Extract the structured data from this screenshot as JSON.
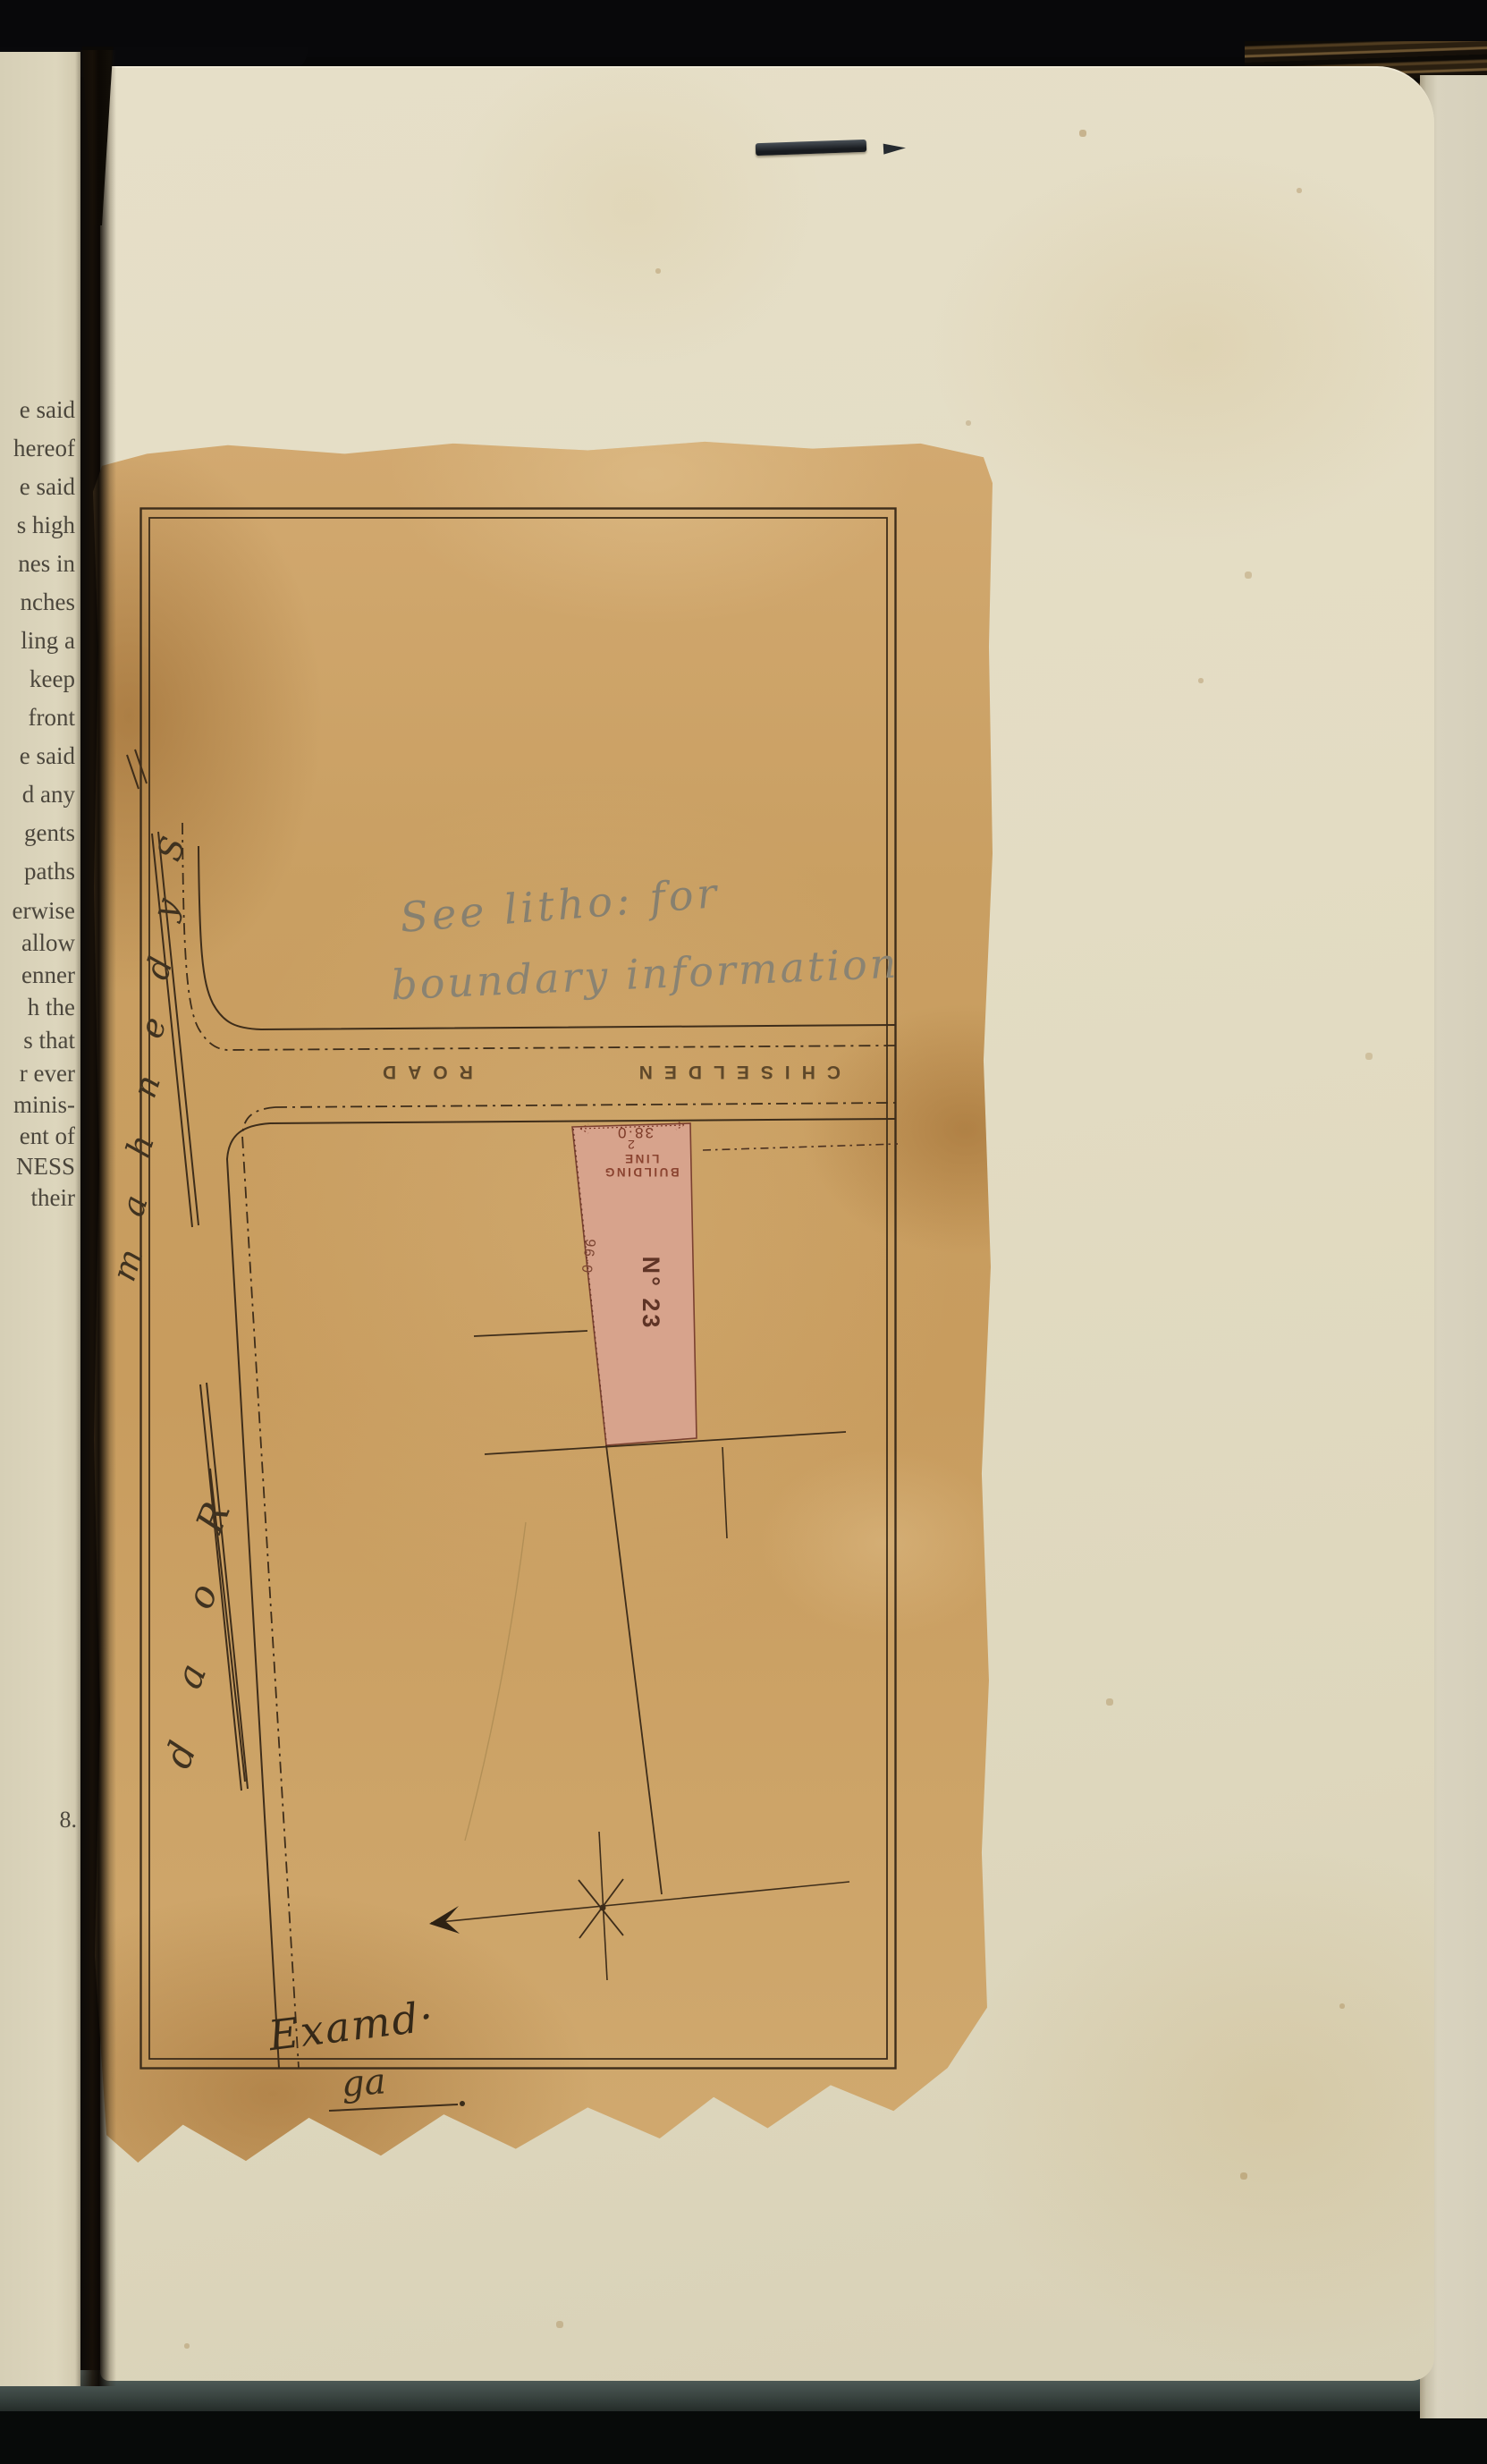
{
  "book": {
    "left_page_fragments": [
      "e said",
      "hereof",
      "e said",
      "s high",
      "nes in",
      "nches",
      "ling a",
      "keep",
      "front",
      "e said",
      "d any",
      "gents",
      "paths",
      "erwise",
      "allow",
      "enner",
      "h the",
      "s that",
      "r ever",
      "minis-",
      "ent of",
      "NESS",
      "their"
    ],
    "left_margin_mark": "8."
  },
  "plan": {
    "pencil_note": {
      "line1": "See litho: for",
      "line2": "boundary information"
    },
    "roads": {
      "chiselden": {
        "name": "CHISELDEN",
        "suffix": "ROAD"
      },
      "sydenham": {
        "name": "Sydenham",
        "suffix": "Road"
      }
    },
    "parcel": {
      "number": "N° 23",
      "frontage": "38·0",
      "depth": "96·0",
      "building_line": "BUILDING LINE",
      "mark": "2"
    },
    "examined_note": "Examd·",
    "examined_initials": "ga",
    "colors": {
      "parcel_fill": "#d8a38f",
      "ink": "#3e2d1a",
      "pencil": "#87806f",
      "paper": "#c99f63"
    }
  }
}
